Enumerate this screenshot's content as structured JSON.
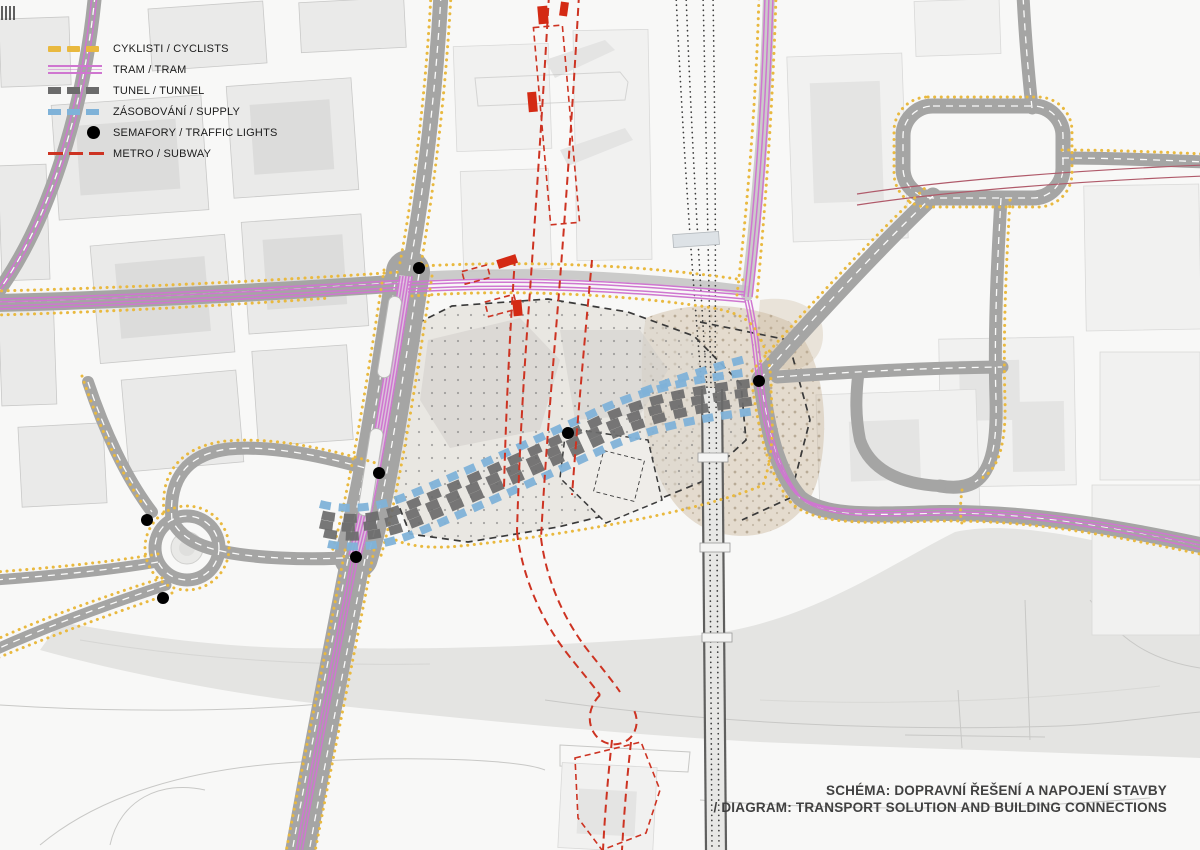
{
  "legend": {
    "items": [
      {
        "id": "cyclists",
        "label": "CYKLISTI / CYCLISTS",
        "swatch": "dashed-thick",
        "color": "#e9b93f"
      },
      {
        "id": "tram",
        "label": "TRAM / TRAM",
        "swatch": "triple-line",
        "color": "#cf76d0"
      },
      {
        "id": "tunnel",
        "label": "TUNEL / TUNNEL",
        "swatch": "dashed-thick",
        "color": "#6b6b6b"
      },
      {
        "id": "supply",
        "label": "ZÁSOBOVÁNÍ / SUPPLY",
        "swatch": "dashed-thick",
        "color": "#7fb2d8"
      },
      {
        "id": "traffic-lights",
        "label": "SEMAFORY / TRAFFIC LIGHTS",
        "swatch": "dot",
        "color": "#000000"
      },
      {
        "id": "metro",
        "label": "METRO / SUBWAY",
        "swatch": "dashed-thin",
        "color": "#cd3322"
      }
    ]
  },
  "caption": {
    "line1": "SCHÉMA: DOPRAVNÍ ŘEŠENÍ A NAPOJENÍ STAVBY",
    "line2": "/ DIAGRAM: TRANSPORT SOLUTION AND BUILDING CONNECTIONS"
  },
  "traffic_lights": {
    "count": 7,
    "positions": [
      {
        "x": 419,
        "y": 268
      },
      {
        "x": 379,
        "y": 473
      },
      {
        "x": 356,
        "y": 557
      },
      {
        "x": 147,
        "y": 520
      },
      {
        "x": 163,
        "y": 598
      },
      {
        "x": 568,
        "y": 433
      },
      {
        "x": 759,
        "y": 381
      }
    ]
  },
  "colors": {
    "cyclists": "#e9b93f",
    "tram": "#cf76d0",
    "tunnel": "#6b6b6b",
    "supply": "#7fb2d8",
    "metro": "#cd3322",
    "traffic_lights": "#000000",
    "road": "#a5a5a4",
    "railway": "#3b3b3b"
  }
}
